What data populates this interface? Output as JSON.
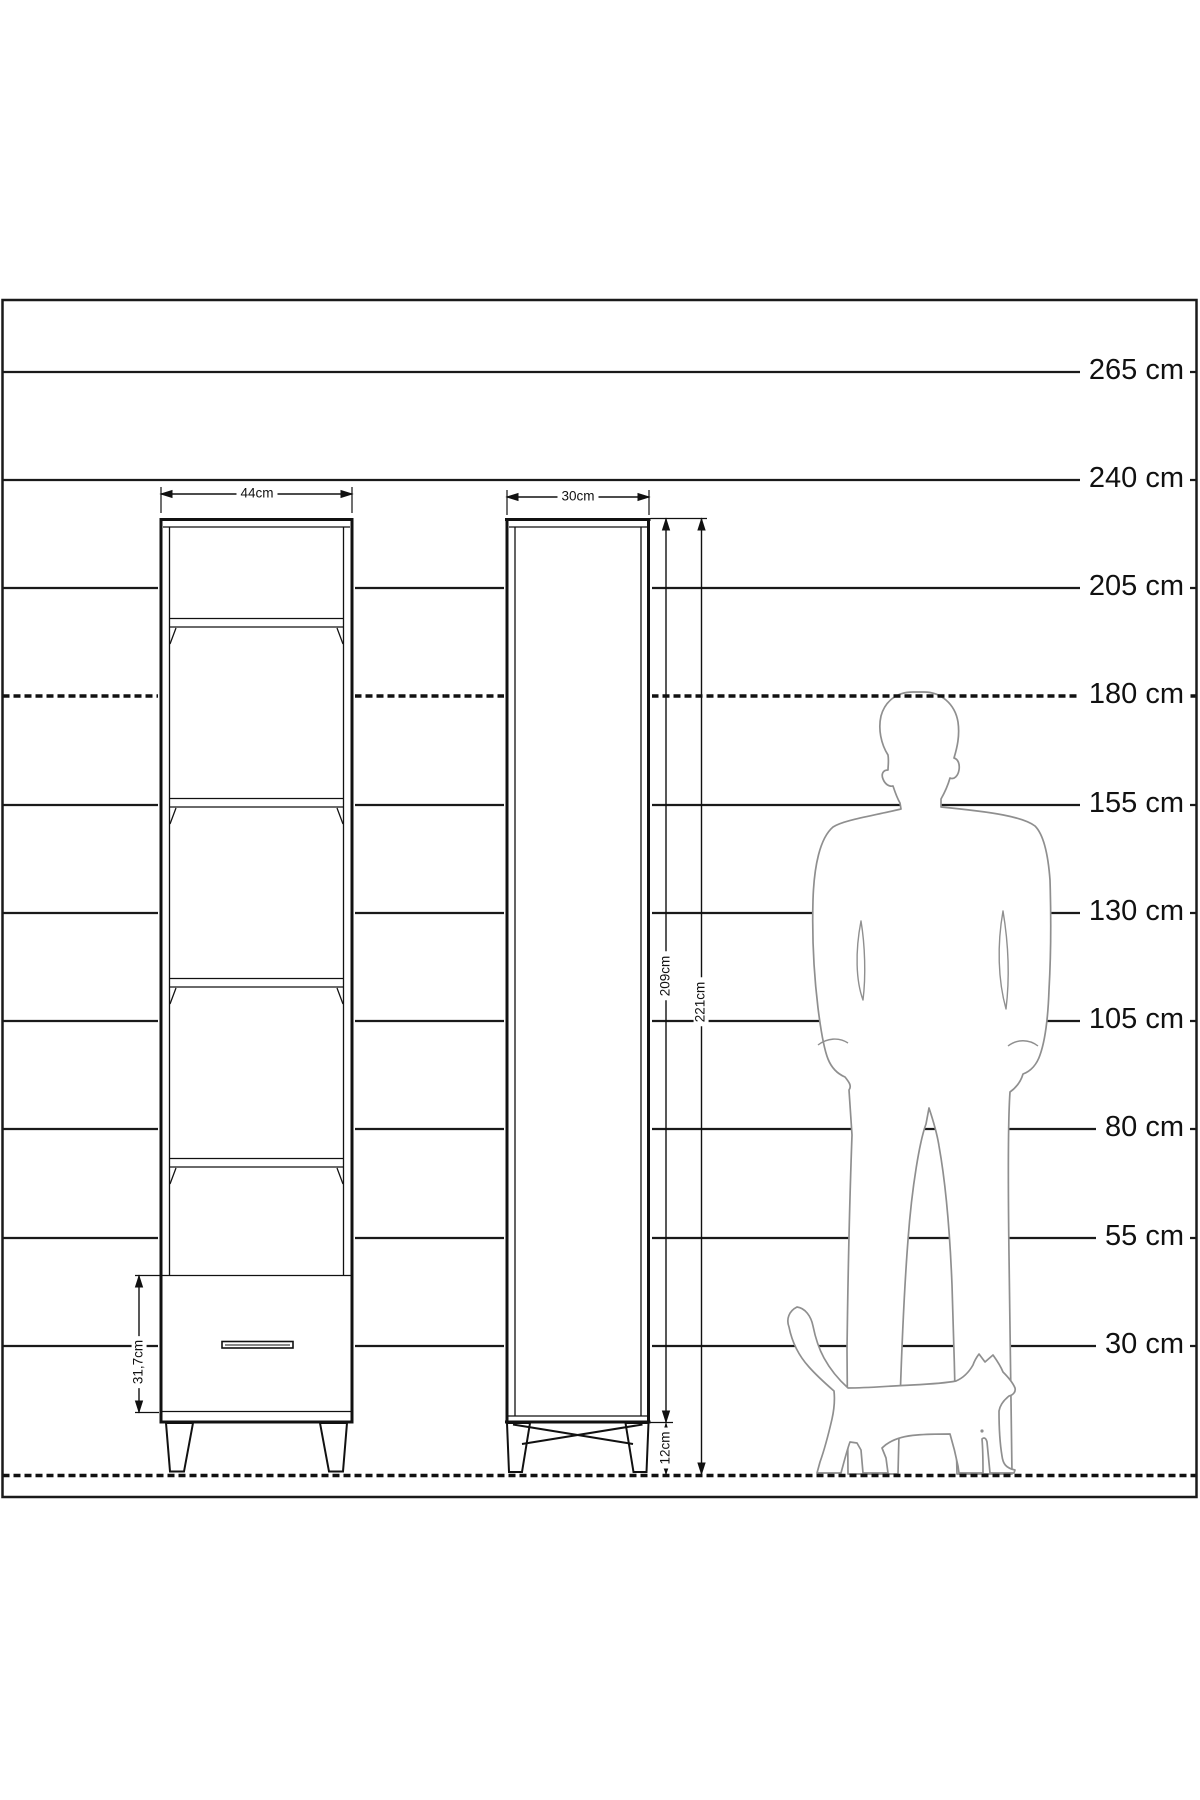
{
  "diagram": {
    "kind": "furniture dimension drawing",
    "unit": "cm",
    "colors": {
      "line": "#1a1a1a",
      "silhouette": "#8f8f8f",
      "background": "#ffffff"
    },
    "height_scale": {
      "labels": [
        "265 cm",
        "240 cm",
        "205 cm",
        "180 cm",
        "155 cm",
        "130 cm",
        "105 cm",
        "80 cm",
        "55 cm",
        "30 cm"
      ],
      "values_cm": [
        265,
        240,
        205,
        180,
        155,
        130,
        105,
        80,
        55,
        30
      ],
      "dashed_reference_cm": 180
    },
    "furniture": {
      "front_view": {
        "width_label": "44cm",
        "drawer_height_label": "31,7cm"
      },
      "side_view": {
        "depth_label": "30cm",
        "body_height_label": "209cm",
        "total_height_label": "221cm",
        "leg_height_label": "12cm"
      }
    }
  }
}
